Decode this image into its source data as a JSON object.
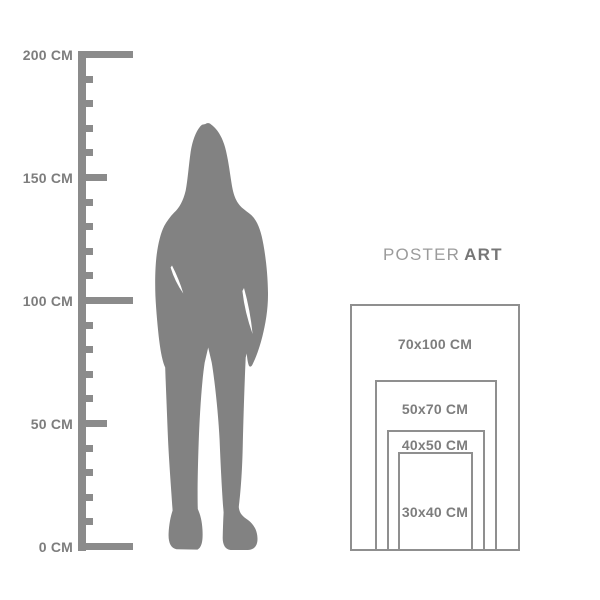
{
  "colors": {
    "figure_gray": "#828282",
    "ruler_gray": "#8b8b8b",
    "rect_border": "#8f8f8f",
    "label_text": "#7d7d7d",
    "brand_regular": "#9b9b9b",
    "brand_bold": "#767676",
    "background": "#ffffff"
  },
  "ruler": {
    "unit": "CM",
    "range": {
      "min_cm": 0,
      "max_cm": 200,
      "minor_step_cm": 10,
      "labeled_step_cm": 50
    },
    "labels": [
      {
        "text": "200 CM"
      },
      {
        "text": "150 CM"
      },
      {
        "text": "100 CM"
      },
      {
        "text": "50 CM"
      },
      {
        "text": "0 CM"
      }
    ]
  },
  "figure": {
    "description": "standing woman silhouette"
  },
  "brand": {
    "regular": "POSTER",
    "bold": "ART"
  },
  "posters": {
    "items": [
      {
        "label": "70x100 CM",
        "width_cm": 70,
        "height_cm": 100
      },
      {
        "label": "50x70 CM",
        "width_cm": 50,
        "height_cm": 70
      },
      {
        "label": "40x50 CM",
        "width_cm": 40,
        "height_cm": 50
      },
      {
        "label": "30x40 CM",
        "width_cm": 30,
        "height_cm": 40
      }
    ]
  }
}
